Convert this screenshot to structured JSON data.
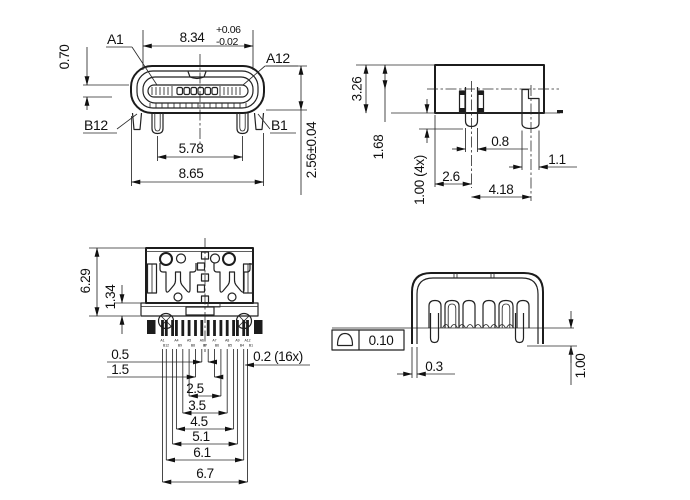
{
  "drawing": {
    "front_view": {
      "pin_a1": "A1",
      "pin_a12": "A12",
      "pin_b12": "B12",
      "pin_b1": "B1",
      "dim_width_inner": "8.34",
      "dim_width_tol_plus": "+0.06",
      "dim_width_tol_minus": "-0.02",
      "dim_tongue_thickness": "0.70",
      "dim_leg_span": "5.78",
      "dim_width_outer": "8.65",
      "dim_height": "2.56±0.04"
    },
    "side_view": {
      "dim_height": "3.26",
      "dim_top_to_center": "1.68",
      "dim_leg_protrusion": "1.00 (4x)",
      "dim_front_leg_width": "0.8",
      "dim_rear_leg_width": "1.1",
      "dim_edge_to_leg": "2.6",
      "dim_leg_pitch": "4.18"
    },
    "top_view": {
      "dim_body_depth": "6.29",
      "dim_flange": "1.34",
      "dim_pitch_1": "0.5",
      "dim_pitch_2": "1.5",
      "dim_pitch_3": "2.5",
      "dim_pitch_4": "3.5",
      "dim_pitch_5": "4.5",
      "dim_pitch_6": "5.1",
      "dim_pitch_7": "6.1",
      "dim_pitch_8": "6.7",
      "dim_pad_width": "0.2 (16x)",
      "pin_labels_top": [
        "A1",
        "A4",
        "A5",
        "A6",
        "A7",
        "A8",
        "A9",
        "A12"
      ],
      "pin_labels_bottom": [
        "B12",
        "B9",
        "B8",
        "B7",
        "B6",
        "B5",
        "B4",
        "B1"
      ]
    },
    "rear_view": {
      "tolerance_value": "0.10",
      "dim_wall_thickness": "0.3",
      "dim_leg_protrusion": "1.00"
    }
  }
}
